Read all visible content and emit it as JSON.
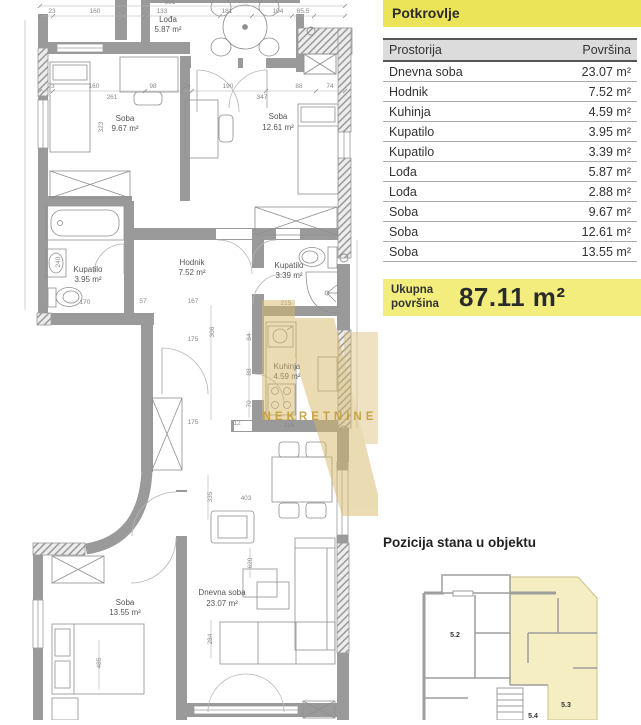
{
  "colors": {
    "header_yellow": "#ece458",
    "total_yellow": "#f2ed7d",
    "minimap_highlight": "#f5eec2",
    "watermark_gold": "#d7b96a",
    "table_header_bg": "#dcdcdc"
  },
  "panel": {
    "title": "Potkrovlje",
    "table": {
      "col_room": "Prostorija",
      "col_area": "Površina",
      "rows": [
        {
          "room": "Dnevna soba",
          "area": "23.07 m²"
        },
        {
          "room": "Hodnik",
          "area": "7.52 m²"
        },
        {
          "room": "Kuhinja",
          "area": "4.59 m²"
        },
        {
          "room": "Kupatilo",
          "area": "3.95 m²"
        },
        {
          "room": "Kupatilo",
          "area": "3.39 m²"
        },
        {
          "room": "Lođa",
          "area": "5.87 m²"
        },
        {
          "room": "Lođa",
          "area": "2.88 m²"
        },
        {
          "room": "Soba",
          "area": "9.67 m²"
        },
        {
          "room": "Soba",
          "area": "12.61 m²"
        },
        {
          "room": "Soba",
          "area": "13.55 m²"
        }
      ]
    },
    "total": {
      "label_line1": "Ukupna",
      "label_line2": "površina",
      "value": "87.11 m²"
    },
    "position_title": "Pozicija stana u objektu",
    "minimap_units": {
      "u52": "5.2",
      "u53": "5.3",
      "u54": "5.4"
    }
  },
  "floorplan": {
    "watermark": "NEKRETNINE",
    "rooms": [
      {
        "name": "Lođa",
        "area": "5.87 m²"
      },
      {
        "name": "Soba",
        "area": "9.67 m²"
      },
      {
        "name": "Soba",
        "area": "12.61 m²"
      },
      {
        "name": "Kupatilo",
        "area": "3.95 m²"
      },
      {
        "name": "Hodnik",
        "area": "7.52 m²"
      },
      {
        "name": "Kupatilo",
        "area": "3.39 m²"
      },
      {
        "name": "Kuhinja",
        "area": "4.59 m²"
      },
      {
        "name": "Soba",
        "area": "13.55 m²"
      },
      {
        "name": "Dnevna soba",
        "area": "23.07 m²"
      }
    ],
    "dims": [
      "531",
      "23",
      "160",
      "133",
      "181",
      "104",
      "85.5",
      "23",
      "160",
      "98",
      "24",
      "190",
      "88",
      "74",
      "261",
      "347",
      "323",
      "240",
      "170",
      "57",
      "167",
      "175",
      "306",
      "84",
      "88",
      "70",
      "175",
      "12",
      "216",
      "215",
      "335",
      "403",
      "620",
      "284",
      "485"
    ]
  }
}
